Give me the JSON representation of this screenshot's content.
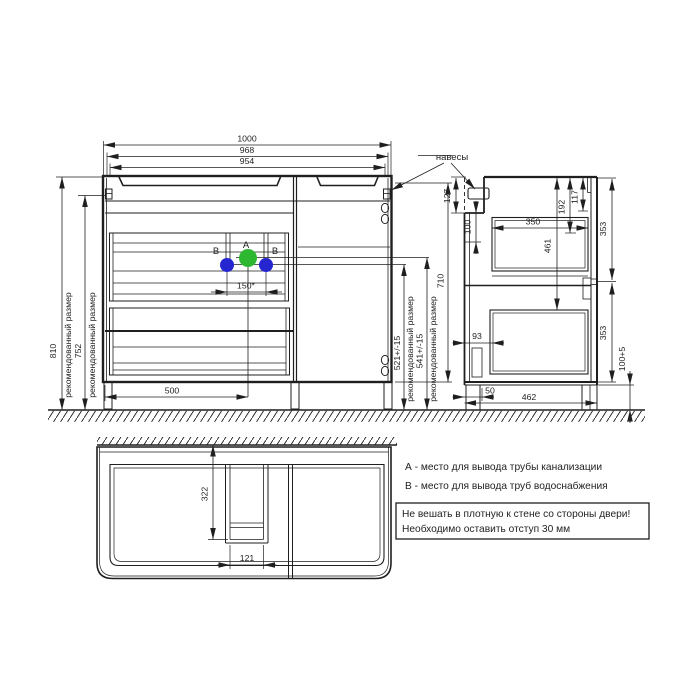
{
  "colors": {
    "ink": "#1f1f1f",
    "point_a": "#2eb832",
    "point_b": "#2526cf"
  },
  "labels": {
    "hangers": "навесы",
    "recommended": "рекомендованный размер",
    "point_a": "A",
    "point_b": "B"
  },
  "front_view": {
    "dims": {
      "overall_width": "1000",
      "top_width": "968",
      "basin_width": "954",
      "overall_height": "810",
      "mount_height": "752",
      "body_height": "710",
      "drain_height": "541+/-15",
      "water_height": "521+/-15",
      "outlet_spacing": "150*",
      "drain_offset": "500"
    }
  },
  "side_view": {
    "dims": {
      "recess_height": "127",
      "rail_clearance": "100",
      "drawer_depth": "350",
      "inner_height": "461",
      "top_clearance": "192",
      "top_offset": "117",
      "upper_front_height": "353",
      "lower_front_height": "353",
      "leg_height": "100+5",
      "leg_offset": "50",
      "depth": "462",
      "drawer_back_gap": "93"
    }
  },
  "bottom_view": {
    "dims": {
      "cutout_from_wall": "322",
      "cutout_width": "121"
    }
  },
  "legend": {
    "line_a": "А - место для вывода трубы канализации",
    "line_b": "В - место для вывода труб водоснабжения"
  },
  "warning": {
    "line1": "Не вешать в плотную к стене со стороны двери!",
    "line2": "Необходимо оставить отступ 30 мм"
  }
}
